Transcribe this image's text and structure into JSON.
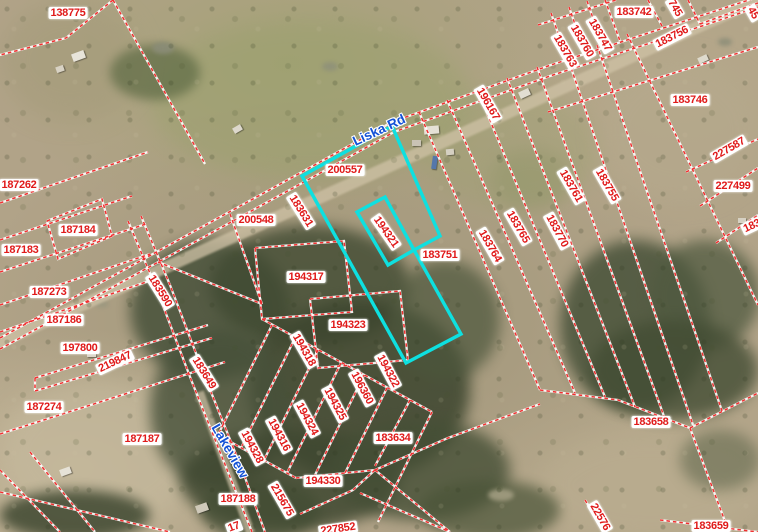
{
  "map": {
    "colors": {
      "parcel_line": "#f03030",
      "parcel_label_text": "#e01a1a",
      "parcel_label_bg": "#ffffff",
      "highlight": "#0ee0e0",
      "road_label_text": "#1452d6"
    },
    "road_labels": [
      {
        "text": "Liska Rd",
        "x": 379,
        "y": 130,
        "r": -25
      },
      {
        "text": "Lakeview",
        "x": 230,
        "y": 451,
        "r": 60
      }
    ],
    "parcel_labels": [
      {
        "text": "138775",
        "x": 68,
        "y": 13,
        "r": 0
      },
      {
        "text": "183742",
        "x": 634,
        "y": 12,
        "r": 0
      },
      {
        "text": "745",
        "x": 675,
        "y": 8,
        "r": 60
      },
      {
        "text": "45",
        "x": 753,
        "y": 13,
        "r": 60
      },
      {
        "text": "183756",
        "x": 672,
        "y": 37,
        "r": -27
      },
      {
        "text": "183747",
        "x": 600,
        "y": 35,
        "r": 60
      },
      {
        "text": "183760",
        "x": 582,
        "y": 41,
        "r": 60
      },
      {
        "text": "183763",
        "x": 565,
        "y": 51,
        "r": 60
      },
      {
        "text": "183746",
        "x": 690,
        "y": 100,
        "r": 0
      },
      {
        "text": "196167",
        "x": 488,
        "y": 104,
        "r": 60
      },
      {
        "text": "227587",
        "x": 729,
        "y": 149,
        "r": -30
      },
      {
        "text": "227499",
        "x": 733,
        "y": 186,
        "r": 0
      },
      {
        "text": "183",
        "x": 752,
        "y": 226,
        "r": -25
      },
      {
        "text": "187262",
        "x": 19,
        "y": 185,
        "r": 0
      },
      {
        "text": "187184",
        "x": 78,
        "y": 230,
        "r": 0
      },
      {
        "text": "187183",
        "x": 21,
        "y": 250,
        "r": 0
      },
      {
        "text": "187273",
        "x": 49,
        "y": 292,
        "r": 0
      },
      {
        "text": "187186",
        "x": 64,
        "y": 320,
        "r": 0
      },
      {
        "text": "197800",
        "x": 80,
        "y": 348,
        "r": 0
      },
      {
        "text": "219847",
        "x": 115,
        "y": 362,
        "r": -25
      },
      {
        "text": "187274",
        "x": 44,
        "y": 407,
        "r": 0
      },
      {
        "text": "187187",
        "x": 142,
        "y": 439,
        "r": 0
      },
      {
        "text": "200557",
        "x": 345,
        "y": 170,
        "r": 0
      },
      {
        "text": "200548",
        "x": 256,
        "y": 220,
        "r": 0
      },
      {
        "text": "183631",
        "x": 301,
        "y": 211,
        "r": 58
      },
      {
        "text": "194321",
        "x": 386,
        "y": 232,
        "r": 55
      },
      {
        "text": "183751",
        "x": 440,
        "y": 255,
        "r": 0
      },
      {
        "text": "194317",
        "x": 306,
        "y": 277,
        "r": 0
      },
      {
        "text": "183590",
        "x": 160,
        "y": 291,
        "r": 58
      },
      {
        "text": "194323",
        "x": 348,
        "y": 325,
        "r": 0
      },
      {
        "text": "183649",
        "x": 204,
        "y": 373,
        "r": 58
      },
      {
        "text": "194318",
        "x": 304,
        "y": 350,
        "r": 60
      },
      {
        "text": "194322",
        "x": 388,
        "y": 371,
        "r": 62
      },
      {
        "text": "196360",
        "x": 362,
        "y": 388,
        "r": 62
      },
      {
        "text": "194325",
        "x": 335,
        "y": 404,
        "r": 62
      },
      {
        "text": "194324",
        "x": 307,
        "y": 419,
        "r": 62
      },
      {
        "text": "194316",
        "x": 279,
        "y": 435,
        "r": 62
      },
      {
        "text": "194328",
        "x": 252,
        "y": 447,
        "r": 62
      },
      {
        "text": "183761",
        "x": 571,
        "y": 186,
        "r": 60
      },
      {
        "text": "183755",
        "x": 607,
        "y": 185,
        "r": 60
      },
      {
        "text": "183770",
        "x": 557,
        "y": 231,
        "r": 62
      },
      {
        "text": "183765",
        "x": 518,
        "y": 227,
        "r": 60
      },
      {
        "text": "183764",
        "x": 490,
        "y": 246,
        "r": 60
      },
      {
        "text": "183634",
        "x": 393,
        "y": 438,
        "r": 0
      },
      {
        "text": "194330",
        "x": 323,
        "y": 481,
        "r": 0
      },
      {
        "text": "187188",
        "x": 238,
        "y": 499,
        "r": 0
      },
      {
        "text": "215675",
        "x": 282,
        "y": 500,
        "r": 60
      },
      {
        "text": "227852",
        "x": 338,
        "y": 529,
        "r": -8
      },
      {
        "text": "17",
        "x": 234,
        "y": 527,
        "r": -20
      },
      {
        "text": "22576",
        "x": 600,
        "y": 517,
        "r": 60
      },
      {
        "text": "183658",
        "x": 651,
        "y": 422,
        "r": 0
      },
      {
        "text": "183659",
        "x": 711,
        "y": 526,
        "r": 0
      }
    ],
    "highlight_parcel": {
      "outer": "302,176 392,126 440,236 414,250 461,334 406,363",
      "inner": "385,197 414,250 388,265 357,212"
    },
    "parcel_lines": [
      "M0,338 L302,172 L392,122 L548,66 L700,16 L758,-3",
      "M0,349 L304,182 L394,132 L550,76 L702,26 L758,7",
      "M113,0 L205,164",
      "M113,0 L66,38 L0,55",
      "M0,203 L148,152",
      "M47,221 L102,199 L112,236 L58,259 L47,221",
      "M0,240 L132,196",
      "M0,272 L146,224",
      "M0,305 L150,254",
      "M0,332 L152,280",
      "M35,378 L208,325",
      "M35,391 L212,338",
      "M35,378 L35,391",
      "M0,434 L225,362",
      "M0,470 L60,532",
      "M30,452 L95,532",
      "M0,492 L170,532",
      "M128,221 L157,290 L192,382 L230,477 L252,532",
      "M141,216 L170,285 L205,377 L243,472 L265,532",
      "M158,262 L262,304",
      "M230,214 L262,304",
      "M255,248 L344,241 L352,312 L262,319 L255,248",
      "M310,299 L400,291 L408,360 L318,368 L310,299",
      "M262,319 L432,412",
      "M272,325 L218,435",
      "M295,338 L241,448",
      "M318,350 L264,460",
      "M341,363 L287,473",
      "M364,375 L315,475",
      "M387,388 L345,473",
      "M410,400 L375,466",
      "M432,412 L378,522",
      "M218,435 L296,478",
      "M296,478 L375,470",
      "M375,470 L450,532",
      "M375,470 L448,438 L540,404",
      "M375,470 L353,490 L300,514",
      "M360,493 L450,532",
      "M419,112 L540,390",
      "M447,100 L575,393",
      "M477,89 L605,397",
      "M507,78 L635,407",
      "M537,67 L665,419",
      "M567,56 L693,425",
      "M597,45 L722,411",
      "M627,34 L758,305",
      "M540,390 L618,400 L690,428",
      "M690,428 L758,393",
      "M690,428 L729,532",
      "M660,520 L758,532",
      "M548,112 L758,47",
      "M686,172 L758,139",
      "M700,206 L758,168",
      "M716,243 L758,215",
      "M538,25 L616,0",
      "M551,13 L567,59",
      "M569,7 L585,53",
      "M587,1 L603,47",
      "M605,0 L620,41",
      "M648,0 L662,26",
      "M688,0 L700,24",
      "M700,24 L758,3",
      "M585,500 L605,532"
    ]
  }
}
